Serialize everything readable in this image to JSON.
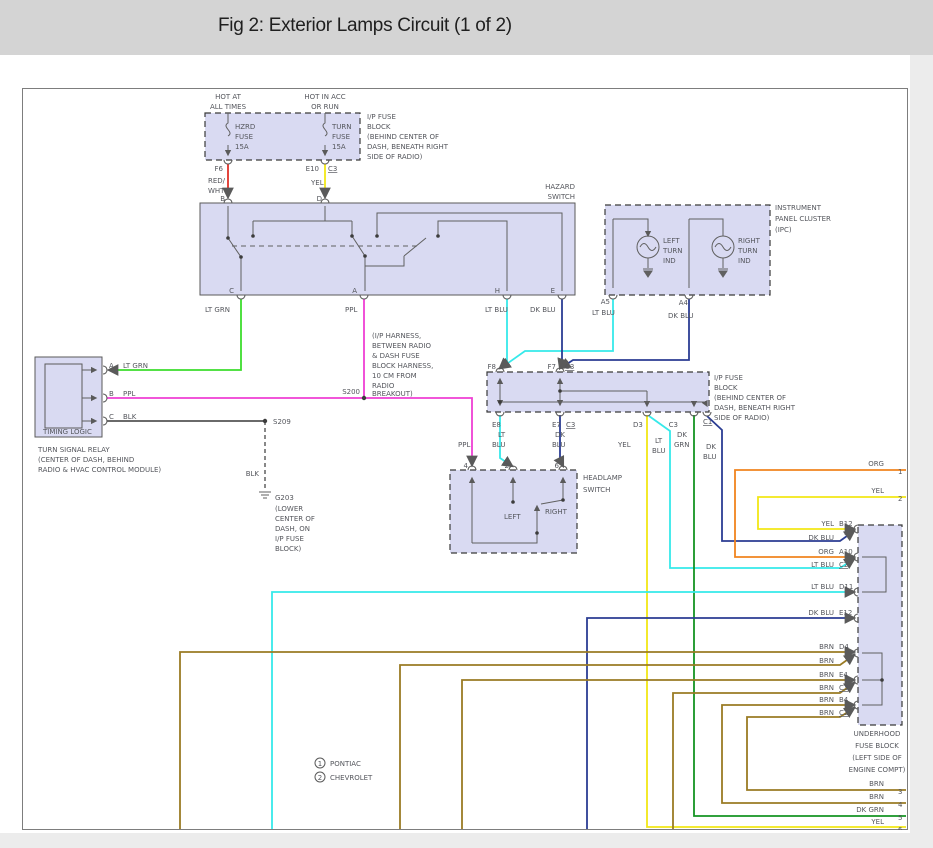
{
  "header": {
    "title": "Fig 2: Exterior Lamps Circuit (1 of 2)"
  },
  "colors": {
    "red": "#e03228",
    "yellow": "#f2e716",
    "lt_grn": "#3ddd2d",
    "ppl": "#ef3fd4",
    "lt_blu": "#36e9ea",
    "dk_blu": "#2b3d93",
    "blk": "#555555",
    "dk_grn": "#149423",
    "brn": "#9a7b24",
    "org": "#f0841e",
    "panel": "#d9daf2",
    "gray_line": "#606060"
  },
  "labels": {
    "hot1a": "HOT AT",
    "hot1b": "ALL TIMES",
    "hot2a": "HOT IN ACC",
    "hot2b": "OR RUN",
    "hzrd1": "HZRD",
    "hzrd2": "FUSE",
    "hzrd3": "15A",
    "turn1": "TURN",
    "turn2": "FUSE",
    "turn3": "15A",
    "ipfb1": "I/P FUSE",
    "ipfb2": "BLOCK",
    "ipfb3": "(BEHIND CENTER OF",
    "ipfb4": "DASH, BENEATH RIGHT",
    "ipfb5": "SIDE OF RADIO)",
    "f6": "F6",
    "e10": "E10",
    "c3": "C3",
    "c1": "C1",
    "c2": "C2",
    "red1": "RED/",
    "red2": "WHT",
    "yel": "YEL",
    "b": "B",
    "d": "D",
    "hazard1": "HAZARD",
    "hazard2": "SWITCH",
    "c": "C",
    "a": "A",
    "h": "H",
    "e": "E",
    "lt_grn": "LT GRN",
    "ppl": "PPL",
    "lt_blu": "LT BLU",
    "dk_blu": "DK BLU",
    "ipc1": "INSTRUMENT",
    "ipc2": "PANEL CLUSTER",
    "ipc3": "(IPC)",
    "left1": "LEFT",
    "left2": "TURN",
    "left3": "IND",
    "right1": "RIGHT",
    "right2": "TURN",
    "right3": "IND",
    "a5": "A5",
    "a4": "A4",
    "timing": "TIMING LOGIC",
    "tsr1": "TURN SIGNAL RELAY",
    "tsr2": "(CENTER OF DASH, BEHIND",
    "tsr3": "RADIO & HVAC CONTROL MODULE)",
    "blk": "BLK",
    "s200": "S200",
    "s209": "S209",
    "harn1": "(I/P HARNESS,",
    "harn2": "BETWEEN RADIO",
    "harn3": "& DASH FUSE",
    "harn4": "BLOCK HARNESS,",
    "harn5": "10 CM FROM",
    "harn6": "RADIO",
    "harn7": "BREAKOUT)",
    "g203": "G203",
    "g203b": "(LOWER",
    "g203c": "CENTER OF",
    "g203d": "DASH, ON",
    "g203e": "I/P FUSE",
    "g203f": "BLOCK)",
    "f8": "F8",
    "f7": "F7",
    "e8": "E8",
    "e7": "E7",
    "d3": "D3",
    "lt": "LT",
    "blu": "BLU",
    "dk": "DK",
    "grn": "GRN",
    "hls1": "HEADLAMP",
    "hls2": "SWITCH",
    "t4": "4",
    "t2": "2",
    "t6": "6",
    "left": "LEFT",
    "right": "RIGHT",
    "uh1": "UNDERHOOD",
    "uh2": "FUSE BLOCK",
    "uh3": "(LEFT SIDE OF",
    "uh4": "ENGINE COMPT)",
    "b12": "B12",
    "a10": "A10",
    "d11": "D11",
    "e12": "E12",
    "d4": "D4",
    "e4": "E4",
    "b4": "B4",
    "brn": "BRN",
    "org": "ORG",
    "dk_grn": "DK GRN",
    "n1": "1",
    "n2": "2",
    "n3": "3",
    "n4": "4",
    "n5": "5",
    "n6": "6",
    "pontiac": "PONTIAC",
    "chevrolet": "CHEVROLET",
    "leg1": "1",
    "leg2": "2"
  }
}
